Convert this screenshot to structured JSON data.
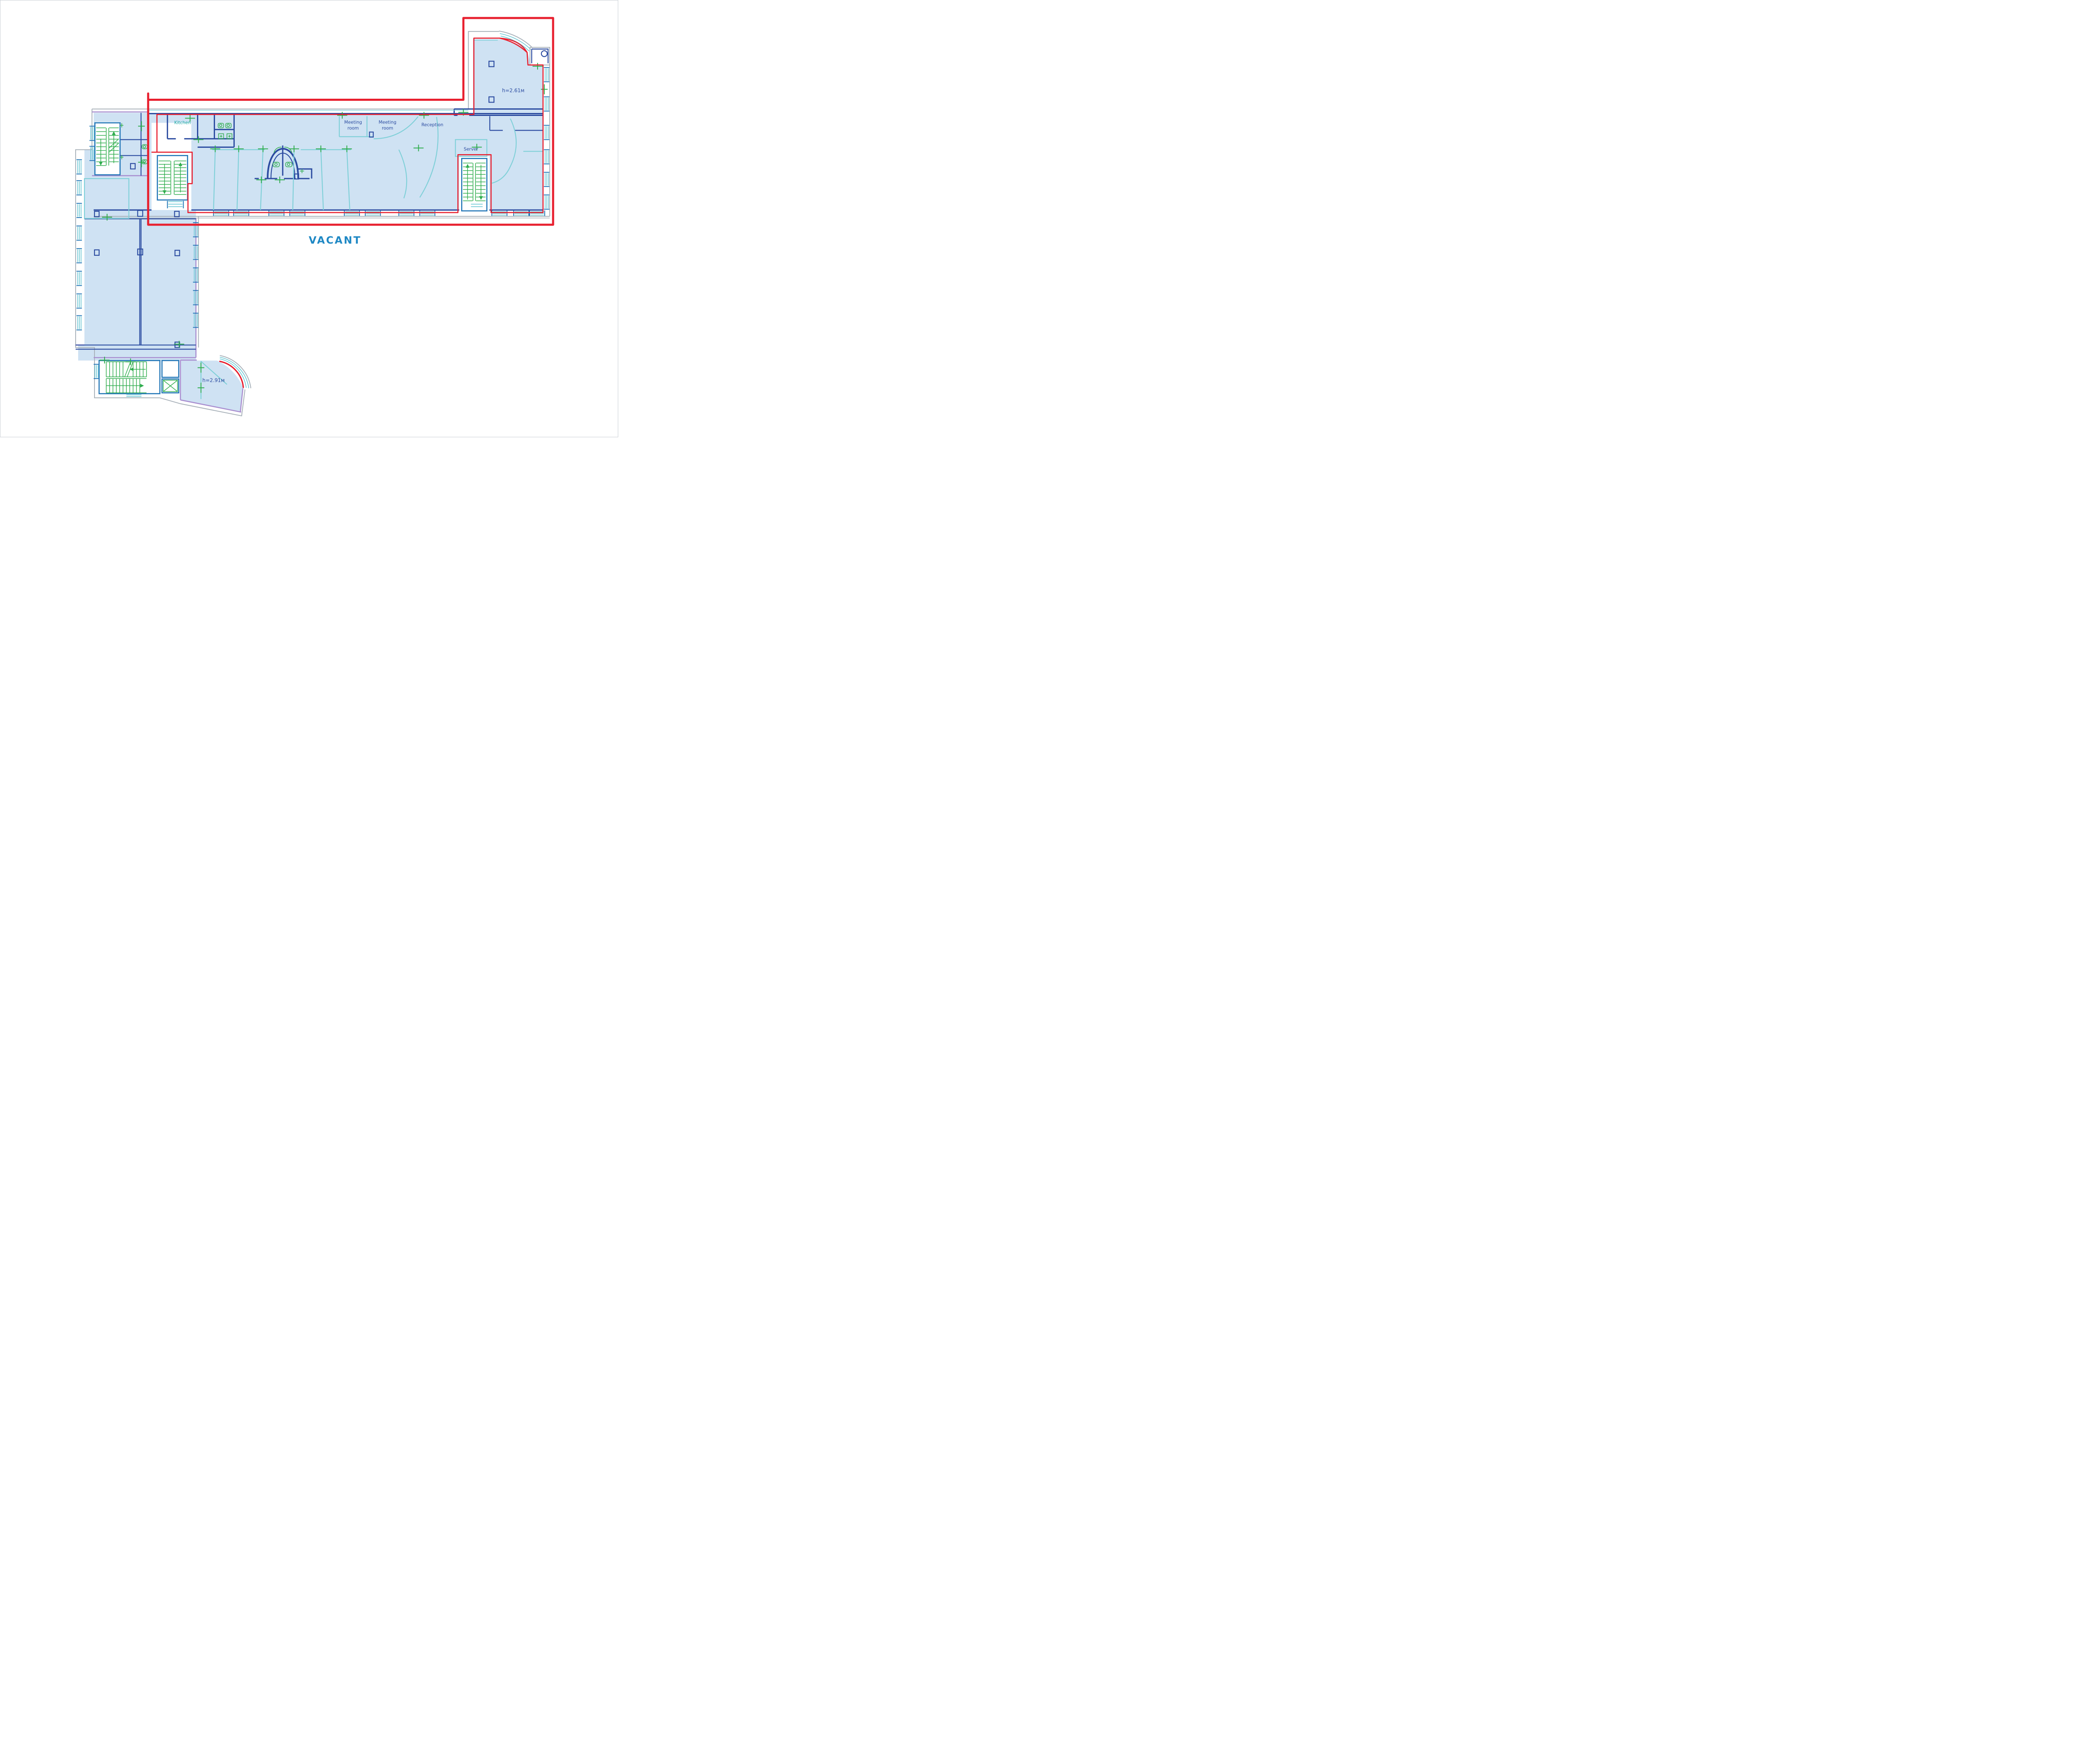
{
  "title": "Office floor plan with vacant area outlined",
  "status": {
    "vacant_label": "VACANT"
  },
  "rooms": {
    "kitchen": "Kitchen",
    "meeting_room_line1": "Meeting",
    "meeting_room_line2": "room",
    "reception": "Reception",
    "server": "Server",
    "ceiling_height_upper": "h=2.61м",
    "ceiling_height_lower": "h=2.91м"
  },
  "colors": {
    "outline_red": "#e8202f",
    "floor_fill": "#cfe2f3",
    "wall_navy": "#2b4ba0",
    "wall_blue": "#2176b7",
    "wall_teal": "#7fd0d8",
    "window_teal": "#66c5d2",
    "wall_purple": "#a98fd0",
    "wall_gray": "#a9b2ba",
    "stairs_green": "#2fad4d",
    "vacant_text": "#1f88c4",
    "kitchen_text": "#16a8a0"
  }
}
